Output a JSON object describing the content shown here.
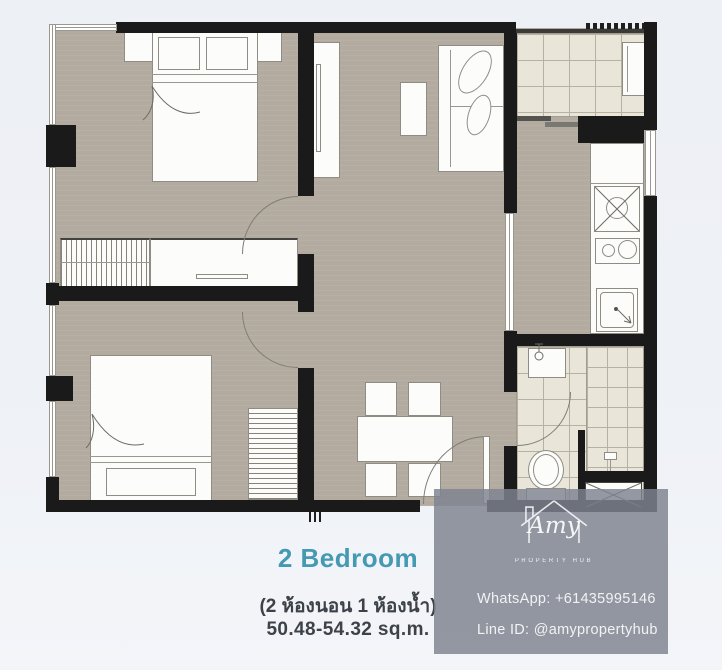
{
  "unit": {
    "title": "2 Bedroom",
    "subtitle_thai": "(2 ห้องนอน 1 ห้องน้ำ)",
    "area_range": "50.48-54.32 sq.m."
  },
  "watermark": {
    "brand_script": "Amy",
    "brand_subtitle": "PROPERTY HUB",
    "whatsapp": "WhatsApp: +61435995146",
    "line_id": "Line ID: @amypropertyhub"
  },
  "colors": {
    "accent_teal": "#4599b3",
    "caption_text": "#3d4249",
    "background": "#eef1f6",
    "floor": "#b3aba0",
    "tile": "#e9e6d9",
    "wall": "#1a1a1a",
    "watermark_overlay": "rgba(126,131,143,0.83)"
  },
  "floor_plan": {
    "rooms": [
      "bedroom-1",
      "bedroom-2",
      "living-dining",
      "kitchen",
      "bathroom",
      "balcony"
    ],
    "fixtures": [
      "double-bed",
      "double-bed",
      "wardrobe",
      "dresser",
      "tv-console",
      "sofa",
      "coffee-table",
      "dining-table-4-chairs",
      "kitchen-counter",
      "kitchen-sink",
      "2-burner-stove",
      "washing-machine",
      "fridge",
      "basin",
      "toilet",
      "shower",
      "ac-condenser",
      "ac-ledge",
      "entry-door",
      "sliding-balcony-door"
    ]
  }
}
